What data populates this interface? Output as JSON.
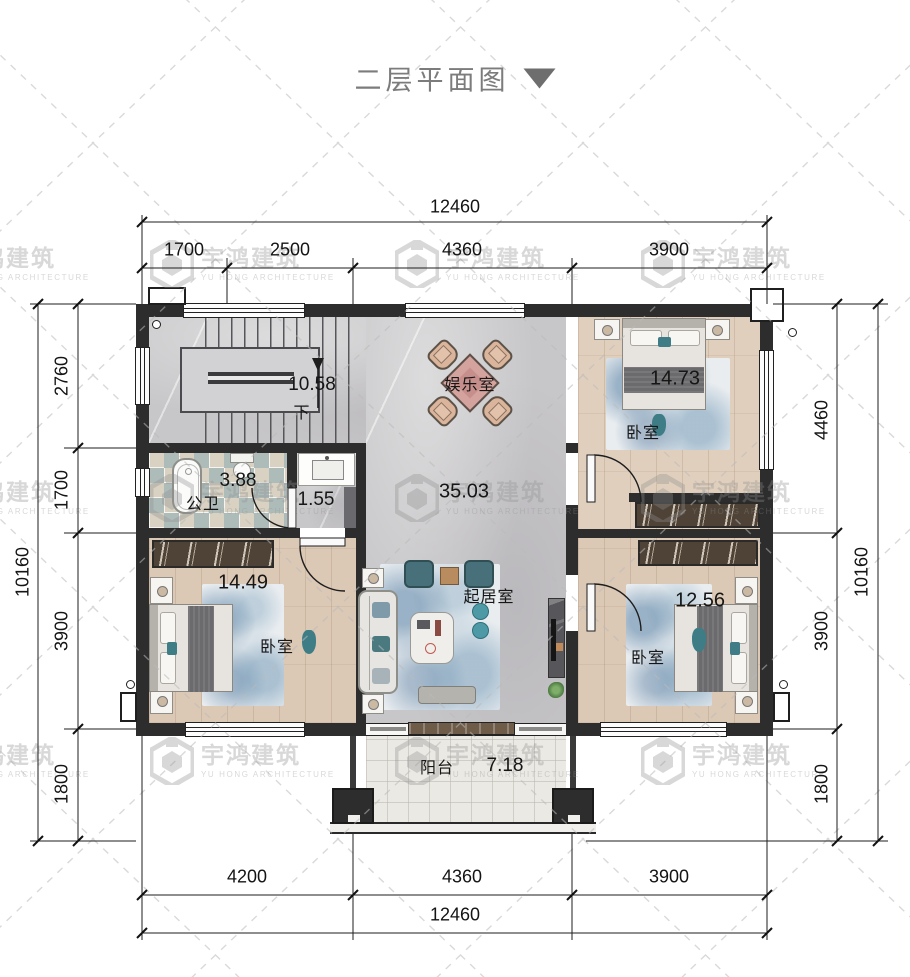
{
  "title": {
    "text": "二层平面图",
    "dropdown_icon": "▼"
  },
  "watermark": {
    "name_cn": "宇鸿建筑",
    "name_en": "YU HONG ARCHITECTURE"
  },
  "dimensions": {
    "top": {
      "overall": "12460",
      "segments": [
        "1700",
        "2500",
        "4360",
        "3900"
      ]
    },
    "bottom": {
      "overall": "12460",
      "segments": [
        "4200",
        "4360",
        "3900"
      ]
    },
    "left": {
      "overall": "10160",
      "segments": [
        "2760",
        "1700",
        "3900",
        "1800"
      ]
    },
    "right": {
      "overall": "10160",
      "segments": [
        "4460",
        "3900",
        "1800"
      ]
    }
  },
  "rooms": {
    "stairwell": {
      "area": "10.58",
      "down_label": "下"
    },
    "entertainment": {
      "name": "娱乐室"
    },
    "hall": {
      "area": "35.03"
    },
    "bathroom": {
      "name": "公卫",
      "area": "3.88"
    },
    "washbasin": {
      "area": "1.55"
    },
    "bedroom_top_right": {
      "name": "卧室",
      "area": "14.73"
    },
    "bedroom_bottom_left": {
      "name": "卧室",
      "area": "14.49"
    },
    "bedroom_bottom_right": {
      "name": "卧室",
      "area": "12.56"
    },
    "living_room": {
      "name": "起居室"
    },
    "balcony": {
      "name": "阳台",
      "area": "7.18"
    }
  },
  "colors": {
    "wall": "#2e2d2d",
    "marble_floor": "#c7c6c8",
    "wood_floor": "#dbc8b5",
    "accent_teal": "#3e7d85",
    "dimension_ink": "#141414",
    "title_gray": "#7c7c7c",
    "watermark_gray": "#8f8f8f"
  }
}
